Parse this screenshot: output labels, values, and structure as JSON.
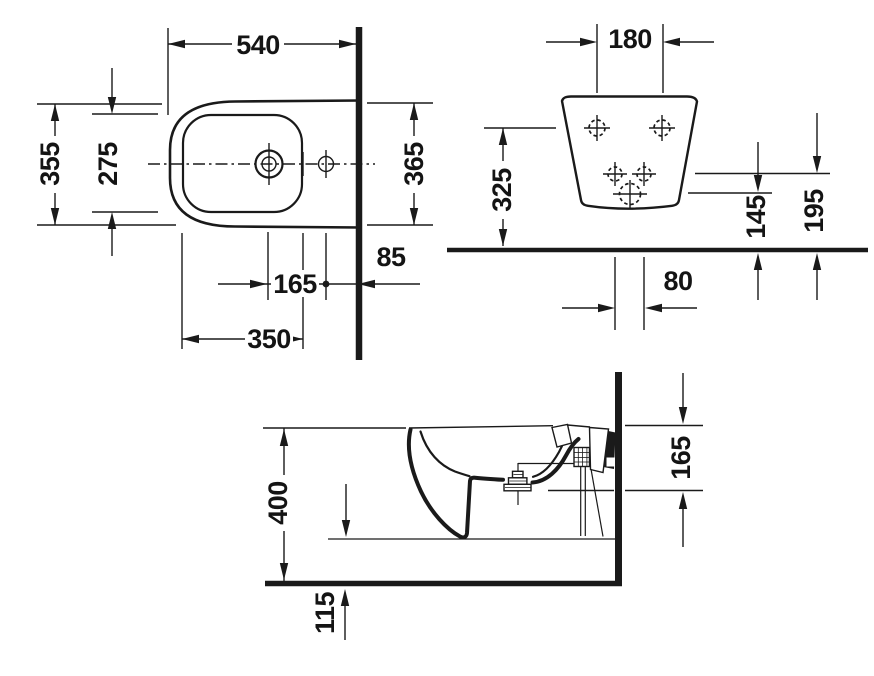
{
  "page": {
    "background": "#ffffff",
    "line_color": "#1a1a1a"
  },
  "views": {
    "plan": {
      "title": "top-view",
      "dims": {
        "total_depth": "540",
        "outer_width": "355",
        "inner_width": "275",
        "width_at_wall": "365",
        "tap_to_drain": "165",
        "drain_to_wall": "85",
        "front_to_drain": "350"
      }
    },
    "rear": {
      "title": "rear-view",
      "dims": {
        "top_hole_spacing": "180",
        "top_holes_height": "325",
        "drain_height": "145",
        "fixing_height": "195",
        "bottom_hole_spacing": "80"
      }
    },
    "side": {
      "title": "side-view",
      "dims": {
        "rim_height": "400",
        "rim_to_fixing_drop": "165",
        "underside_clearance": "115"
      }
    }
  }
}
